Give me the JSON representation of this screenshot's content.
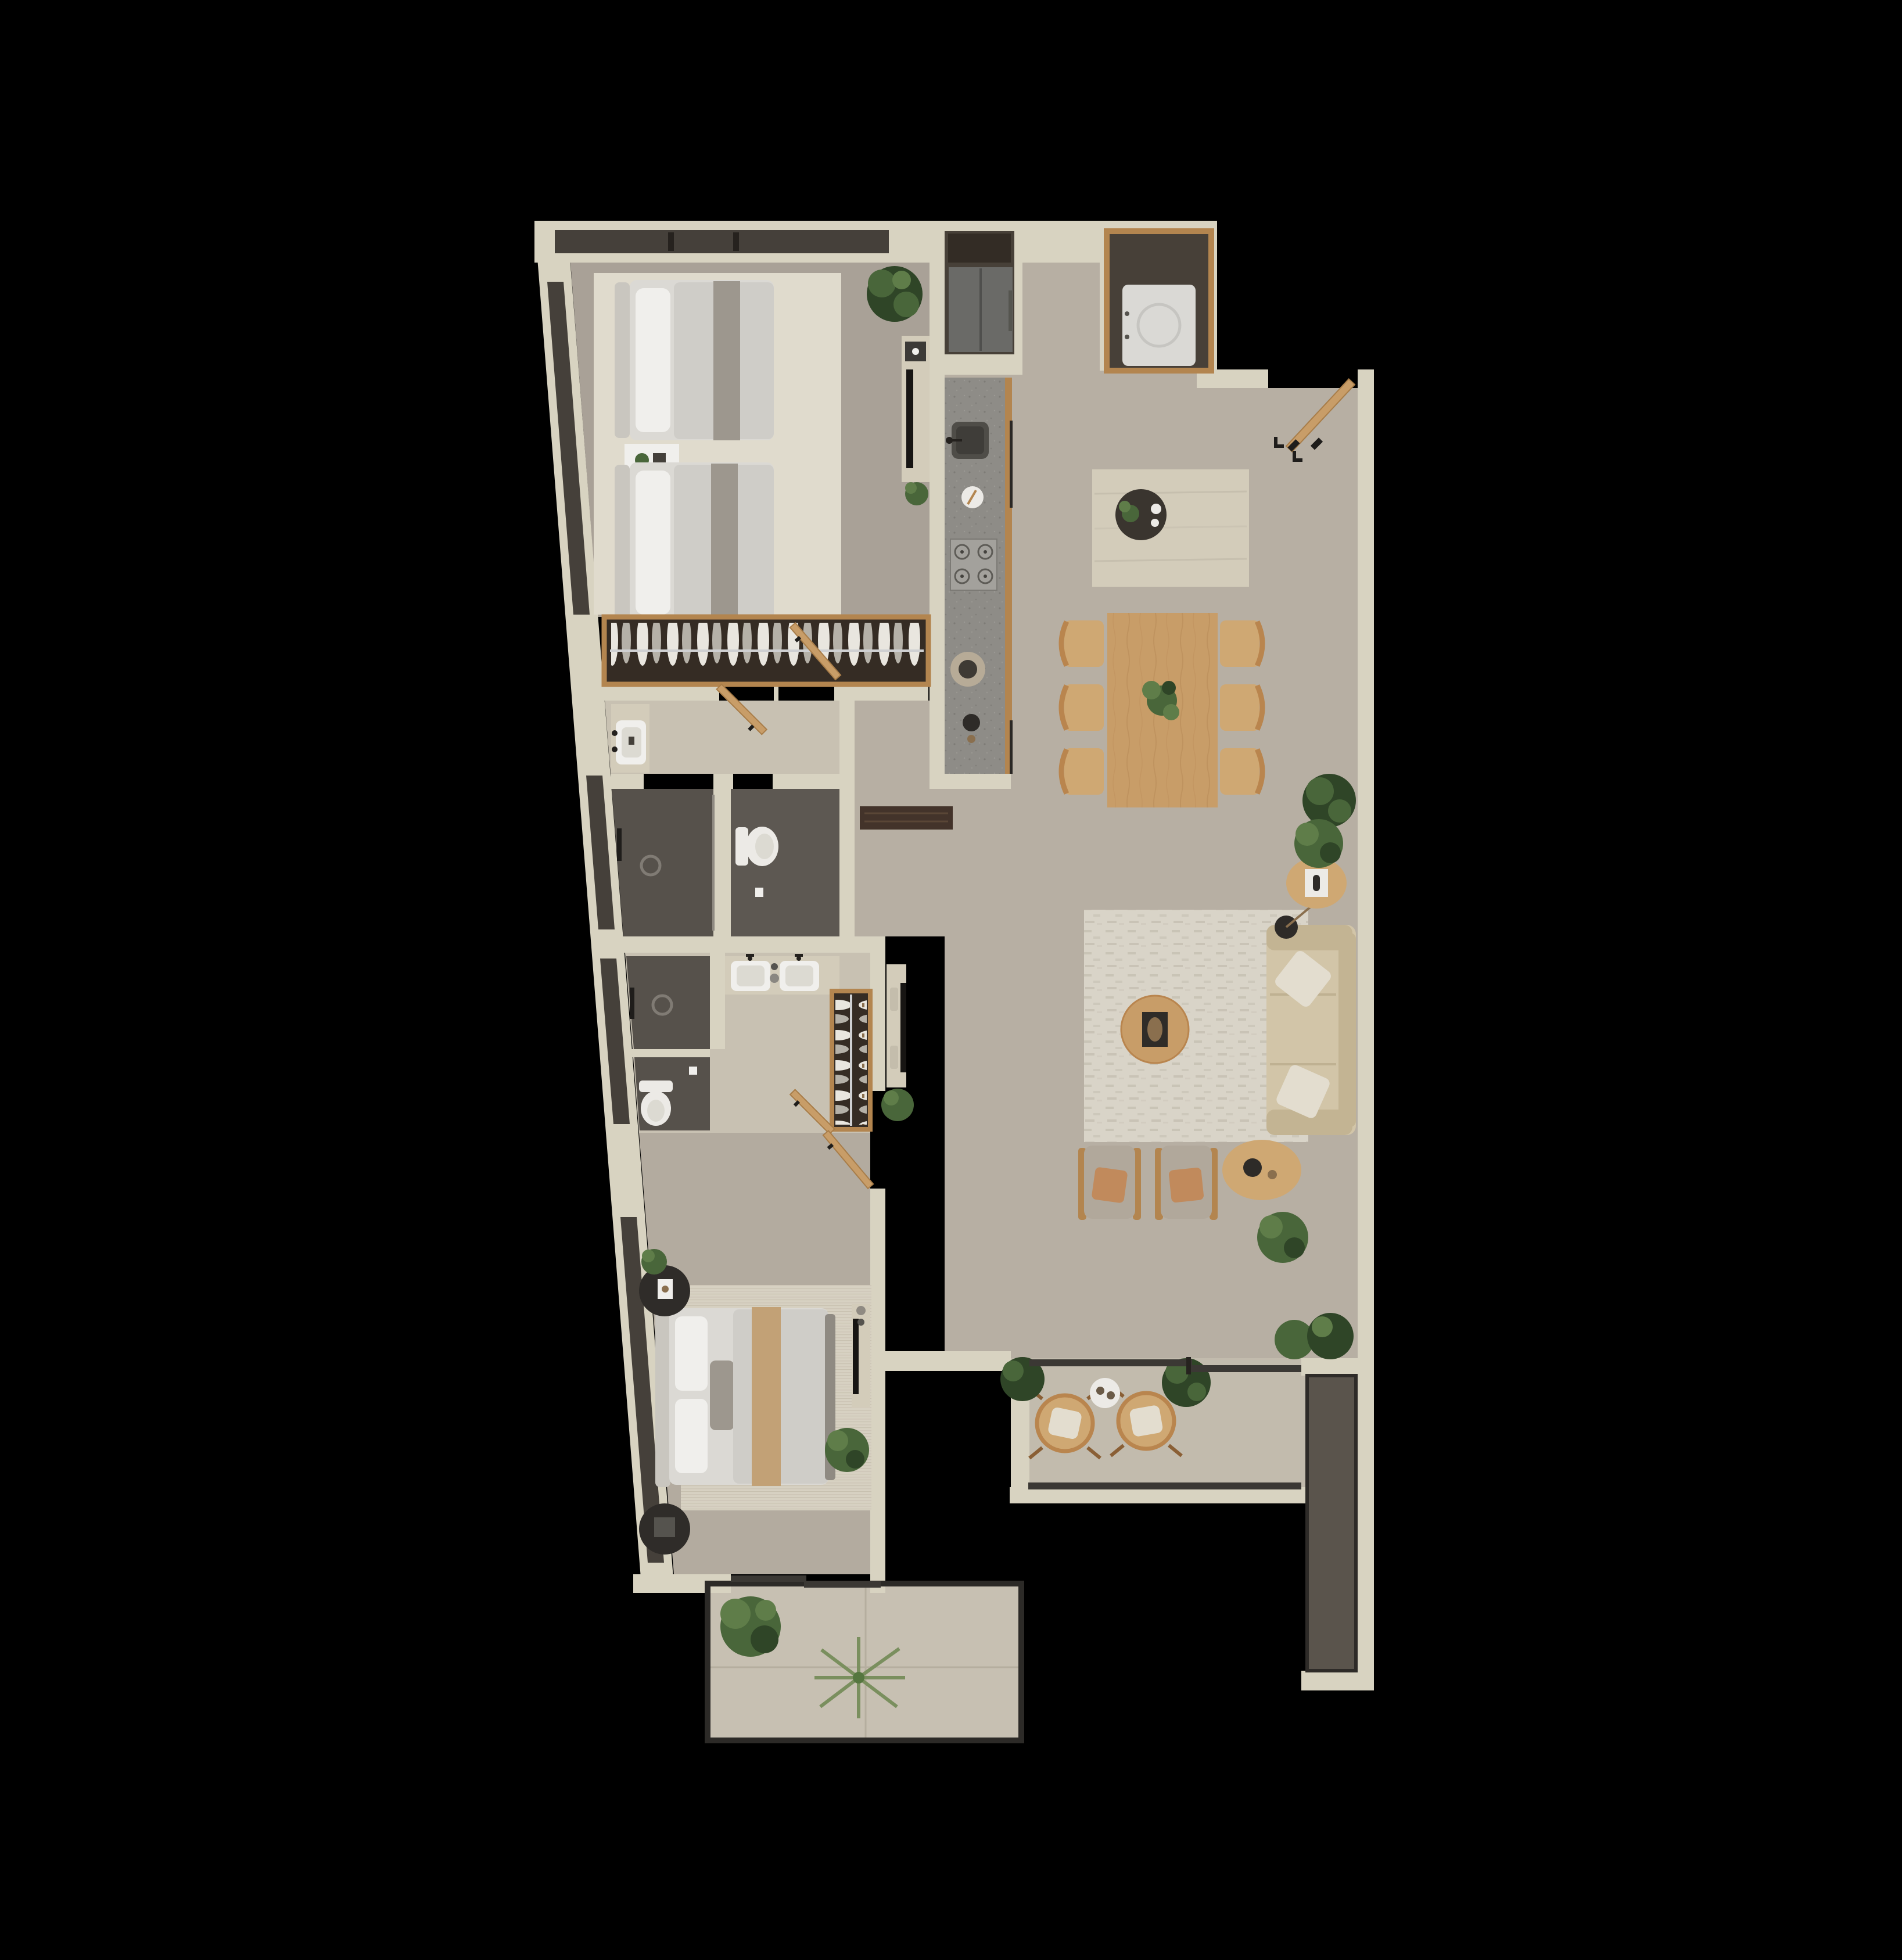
{
  "scene": {
    "type": "architectural-floor-plan-render",
    "view": "top-down-3d",
    "unit": "two-bedroom-apartment",
    "background": "#000000"
  },
  "palette": {
    "background": "#000000",
    "wall": "#d8d3c1",
    "wallDeep": "#cfc9b6",
    "floorMain": "#b7afa3",
    "floorBedroom": "#a9a197",
    "floorMaster": "#b3ab9f",
    "floorLight": "#c8c1b2",
    "floorBalcony": "#c2bbad",
    "floorPatio": "#c7c0b2",
    "tileDark": "#56514b",
    "tileDark2": "#5d5852",
    "rugCream": "#e0dbcd",
    "rugLiving": "#d9d4c8",
    "rugMaster": "#d7d1c2",
    "travertine": "#d3ccba",
    "counter": "#8e8c87",
    "woodMid": "#c89d68",
    "woodChair": "#cfa873",
    "woodFrame": "#b3854f",
    "woodDark": "#43332a",
    "closetDark": "#352c24",
    "glass": "#45403a",
    "railDark": "#3b3834",
    "fridge": "#6a6a67",
    "nicheDark": "#474038",
    "cabinetDark": "#332c25",
    "applianceWhite": "#dad9d5",
    "porcelain": "#eceae6",
    "sofa": "#d2c5a8",
    "sofaShadow": "#c3b493",
    "armchair": "#b1a89b",
    "terracotta": "#c18a5c",
    "pillowCream": "#e3ddcf",
    "bedding": "#dbd9d4",
    "duvet": "#cfcdc8",
    "throwGray": "#9d978e",
    "runnerTan": "#c2a176",
    "headboard": "#c9c6bf",
    "plantDark": "#2f4527",
    "plantMid": "#49663a",
    "plantLight": "#5f7d49",
    "black": "#1f1d1b",
    "white": "#f0efec",
    "planter": "#5a544c"
  },
  "plan": {
    "rooms": [
      {
        "name": "twin-bedroom",
        "furniture": [
          "twin-bed",
          "twin-bed",
          "nightstand",
          "area-rug",
          "tv-console",
          "wardrobe-with-clothes",
          "potted-plant",
          "slanted-window",
          "top-window"
        ]
      },
      {
        "name": "kitchen",
        "furniture": [
          "refrigerator",
          "upper-cabinet",
          "counter-run",
          "sink",
          "gas-cooktop",
          "cutting-board",
          "kettle",
          "plate",
          "island",
          "serving-tray"
        ]
      },
      {
        "name": "utility-closet",
        "furniture": [
          "washer-dryer"
        ]
      },
      {
        "name": "dining-area",
        "furniture": [
          "dining-table",
          "dining-chair",
          "dining-chair",
          "dining-chair",
          "dining-chair",
          "dining-chair",
          "dining-chair",
          "table-plant"
        ]
      },
      {
        "name": "living-room",
        "furniture": [
          "three-seat-sofa",
          "cushion",
          "cushion",
          "floor-lamp",
          "round-coffee-table",
          "armchair",
          "armchair",
          "side-table",
          "side-table",
          "tv-console",
          "area-rug",
          "potted-plant",
          "potted-plant",
          "potted-plant",
          "potted-plant"
        ]
      },
      {
        "name": "entry-hall",
        "furniture": [
          "entry-door",
          "wall-hooks",
          "console-bench"
        ]
      },
      {
        "name": "bathroom-1",
        "furniture": [
          "vanity-sink",
          "walk-in-shower",
          "toilet"
        ]
      },
      {
        "name": "master-bathroom",
        "furniture": [
          "double-vanity",
          "walk-in-shower",
          "toilet"
        ]
      },
      {
        "name": "walk-in-closet",
        "furniture": [
          "wardrobe-with-clothes"
        ]
      },
      {
        "name": "master-bedroom",
        "furniture": [
          "double-bed",
          "round-nightstand",
          "round-nightstand",
          "area-rug",
          "tv-console",
          "potted-plant",
          "potted-plant",
          "sliding-door"
        ]
      },
      {
        "name": "balcony",
        "furniture": [
          "round-lounge-chair",
          "round-lounge-chair",
          "side-table",
          "potted-plant",
          "potted-plant",
          "planter-strip",
          "sliding-door",
          "railing"
        ]
      },
      {
        "name": "patio",
        "furniture": [
          "potted-plant",
          "palm-plant"
        ]
      }
    ]
  }
}
